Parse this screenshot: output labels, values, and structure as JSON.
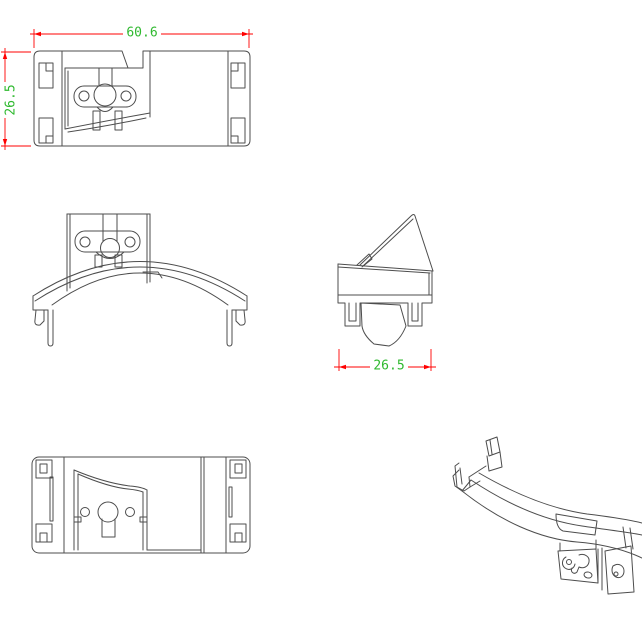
{
  "drawing": {
    "dimensions": {
      "top_view_width": "60.6",
      "top_view_height": "26.5",
      "side_view_width": "26.5"
    },
    "colors": {
      "line": "#4d4d4d",
      "dimension_line": "#ff0000",
      "dimension_text": "#2fb92f",
      "background": "#ffffff"
    }
  }
}
